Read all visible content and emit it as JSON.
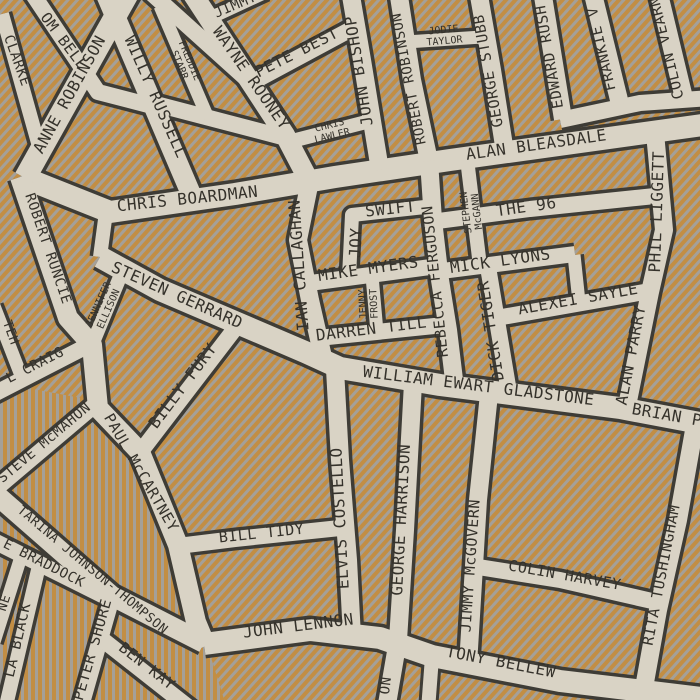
{
  "map": {
    "colors": {
      "street": "#d9d3c5",
      "outline": "#3e3c36",
      "stripe_orange": "#c28e44",
      "stripe_gray": "#a4a099",
      "label": "#35322b"
    },
    "streets": {
      "tom_bell": {
        "label": "OM BELL"
      },
      "clarke": {
        "label": "CLARKE"
      },
      "anne_robinson": {
        "label": "ANNE ROBINSON"
      },
      "willy_russell": {
        "label": "WILLY RUSSELL"
      },
      "freddie_starr": {
        "line1": "FREDDIE",
        "line2": "STARR"
      },
      "wayne_rooney": {
        "label": "WAYNE ROONEY"
      },
      "jimmy_fragment": {
        "label": "JIMMY"
      },
      "pete_best": {
        "label": "PETE BEST"
      },
      "john_bishop": {
        "label": "JOHN BISHOP"
      },
      "chris_lawler": {
        "line1": "CHRIS",
        "line2": "LAWLER"
      },
      "robert_robinson": {
        "label": "ROBERT ROBINSON"
      },
      "jodie_taylor": {
        "line1": "JODIE",
        "line2": "TAYLOR"
      },
      "george_stubbs": {
        "label": "GEORGE STUBB"
      },
      "edward_rush": {
        "label": "EDWARD RUSH"
      },
      "frankie_v": {
        "label": "FRANKIE V"
      },
      "colin_vearn": {
        "label": "COLIN VEARN"
      },
      "alan_bleasdale": {
        "label": "ALAN BLEASDALE"
      },
      "chris_boardman": {
        "label": "CHRIS BOARDMAN"
      },
      "robert_runcie": {
        "label": "ROBERT RUNCIE"
      },
      "teh_fragment": {
        "label": "TEH"
      },
      "l_craig": {
        "label": "L CRAIG"
      },
      "steven_gerrard": {
        "label": "STEVEN GERRARD"
      },
      "jennifer_ellison": {
        "line1": "JENNIFER",
        "line2": "ELLISON"
      },
      "ian_callaghan": {
        "label": "IAN CALLAGHAN"
      },
      "joy": {
        "label": "JOY"
      },
      "swift": {
        "label": "SWIFT"
      },
      "mike_myers": {
        "label": "MIKE MYERS"
      },
      "jenny_frost": {
        "line1": "JENNY",
        "line2": "FROST"
      },
      "darren_till": {
        "label": "DARREN TILL"
      },
      "rebecca_ferguson": {
        "label": "REBECCA FERGUSON"
      },
      "the_96": {
        "label": "THE 96"
      },
      "stephen_mcgann": {
        "line1": "STEPHEN",
        "line2": "McGANN"
      },
      "mick_lyons": {
        "label": "MICK LYONS"
      },
      "dick_tiger": {
        "label": "DICK TIGER"
      },
      "alexei_sayle": {
        "label": "ALEXEI SAYLE"
      },
      "alan_parry": {
        "label": "ALAN PARRY"
      },
      "phil_liggett": {
        "label": "PHIL LIGGETT"
      },
      "william_ewart_gladstone": {
        "label": "WILLIAM EWART GLADSTONE"
      },
      "brian_fragment": {
        "label": "BRIAN P"
      },
      "billy_fury": {
        "label": "BILLY FURY"
      },
      "paul_mccartney": {
        "label": "PAUL McCARTNEY"
      },
      "steve_mcmahon": {
        "label": "STEVE McMAHON"
      },
      "katarina_johnson_thompson": {
        "label": "TARINA JOHNSON-THOMPSON"
      },
      "e_braddock": {
        "label": "E BRADDOCK"
      },
      "ne_fragment": {
        "label": "NE"
      },
      "la_black": {
        "label": "LA BLACK"
      },
      "peter_shore": {
        "label": "PETER SHORE"
      },
      "ben_kay": {
        "label": "BEN KAY"
      },
      "bill_tidy": {
        "label": "BILL TIDY"
      },
      "elvis_costello": {
        "label": "ELVIS COSTELLO"
      },
      "george_harrison": {
        "label": "GEORGE HARRISON"
      },
      "harrison_fragment": {
        "label": "ON"
      },
      "john_lennon": {
        "label": "JOHN LENNON"
      },
      "tony_bellew": {
        "label": "TONY BELLEW"
      },
      "jimmy_mcgovern": {
        "label": "JIMMY McGOVERN"
      },
      "colin_harvey": {
        "label": "COLIN HARVEY"
      },
      "rita_tushingham": {
        "label": "RITA TUSHINGHAM"
      }
    }
  }
}
